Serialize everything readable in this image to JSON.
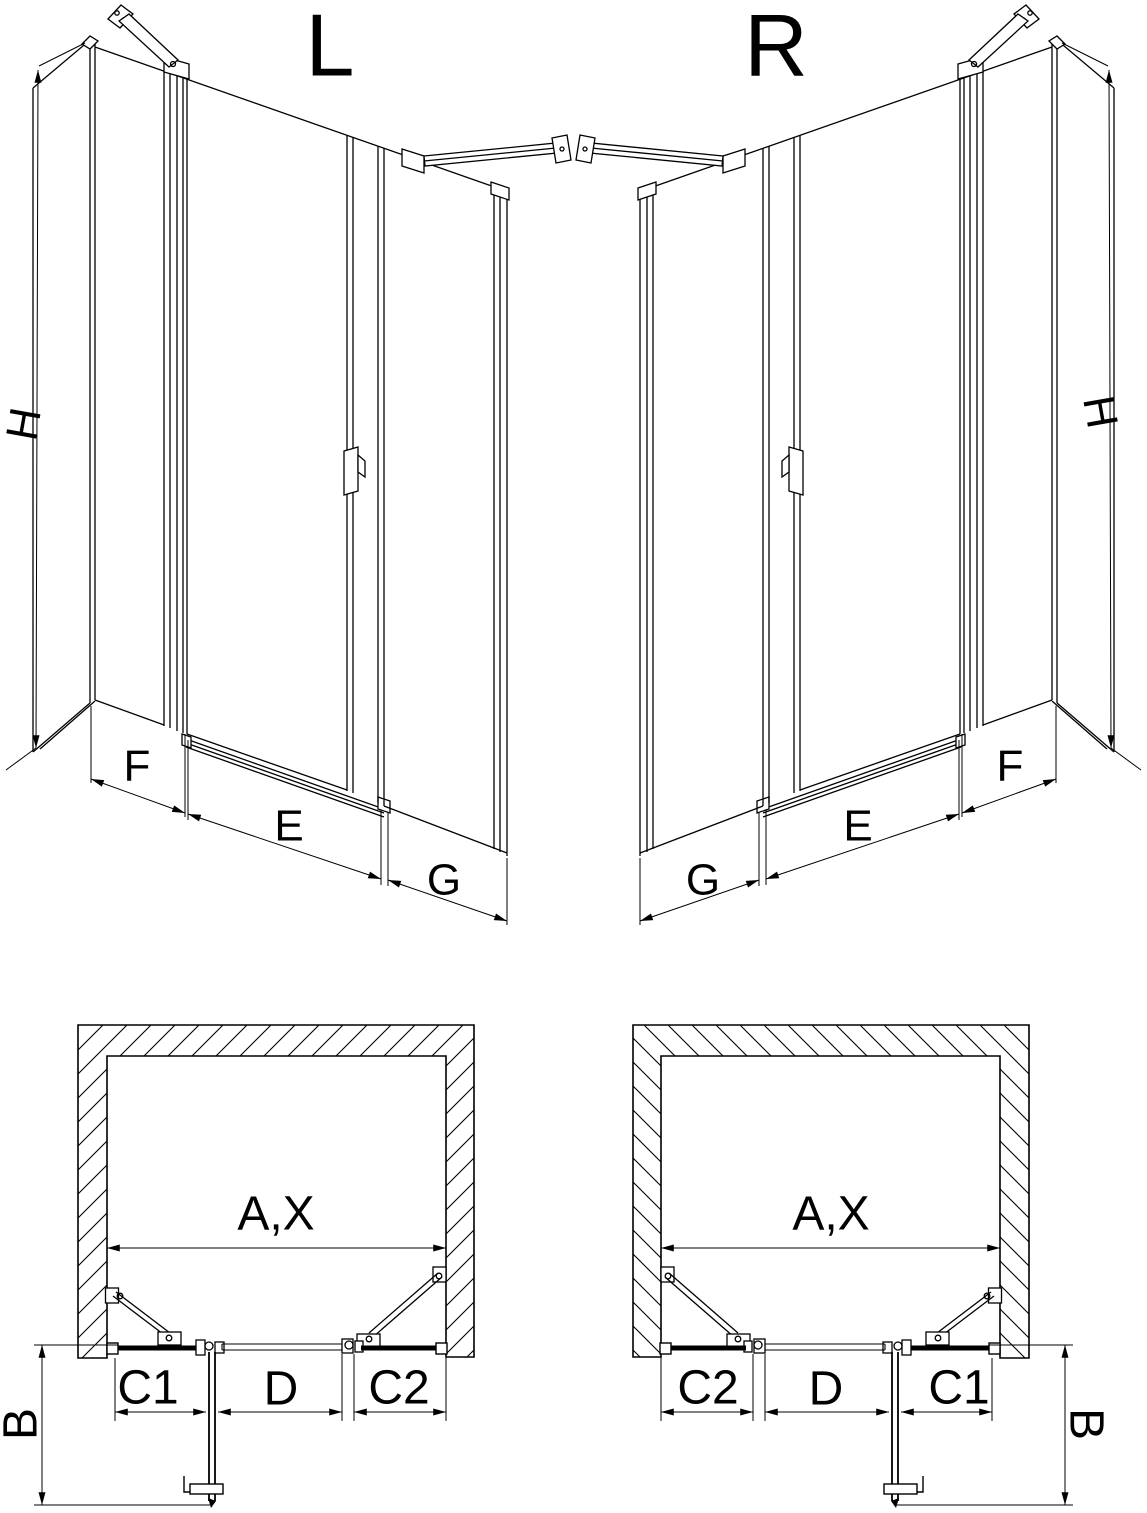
{
  "document": {
    "type": "shower-door-technical-drawing",
    "background": "#ffffff",
    "line_color": "#000000"
  },
  "perspective_views": {
    "left": {
      "variant_label": "L",
      "height_label": "H",
      "segment_labels": {
        "first": "F",
        "second": "E",
        "third": "G"
      }
    },
    "right": {
      "variant_label": "R",
      "height_label": "H",
      "segment_labels": {
        "first": "G",
        "second": "E",
        "third": "F"
      }
    }
  },
  "plan_views": {
    "left": {
      "overall_width_label": "A,X",
      "depth_label": "B",
      "segment_labels": {
        "first": "C1",
        "second": "D",
        "third": "C2"
      }
    },
    "right": {
      "overall_width_label": "A,X",
      "depth_label": "B",
      "segment_labels": {
        "first": "C2",
        "second": "D",
        "third": "C1"
      }
    }
  }
}
